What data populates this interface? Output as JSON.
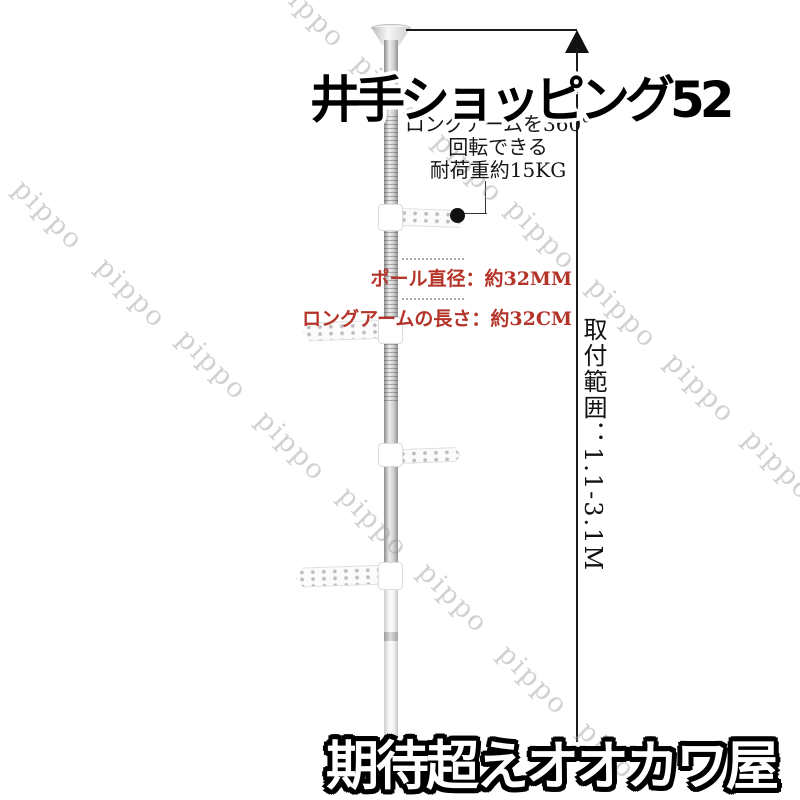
{
  "image": {
    "header_title": "井手ショッピング52",
    "footer_title": "期待超えオオカワ屋",
    "callout": {
      "line1": "ロングアームを360°",
      "line2": "回転できる",
      "line3": "耐荷重約15KG"
    },
    "specs": {
      "pole_diameter": "ポール直径：約32MM",
      "arm_length": "ロングアームの長さ：約32CM"
    },
    "measurement": {
      "install_range": "取付範囲：1.1-3.1M"
    },
    "colors": {
      "spec_red": "#b5342a",
      "line_black": "#1c1c1c",
      "watermark_gray": "#9a9a9a"
    },
    "watermark": {
      "text": "pippo",
      "positions": [
        [
          48,
          215
        ],
        [
          131,
          293
        ],
        [
          212,
          365
        ],
        [
          291,
          446
        ],
        [
          373,
          522
        ],
        [
          453,
          598
        ],
        [
          533,
          680
        ],
        [
          613,
          757
        ],
        [
          310,
          13
        ],
        [
          388,
          90
        ],
        [
          468,
          168
        ],
        [
          541,
          235
        ],
        [
          622,
          313
        ],
        [
          700,
          388
        ],
        [
          778,
          465
        ]
      ]
    }
  }
}
